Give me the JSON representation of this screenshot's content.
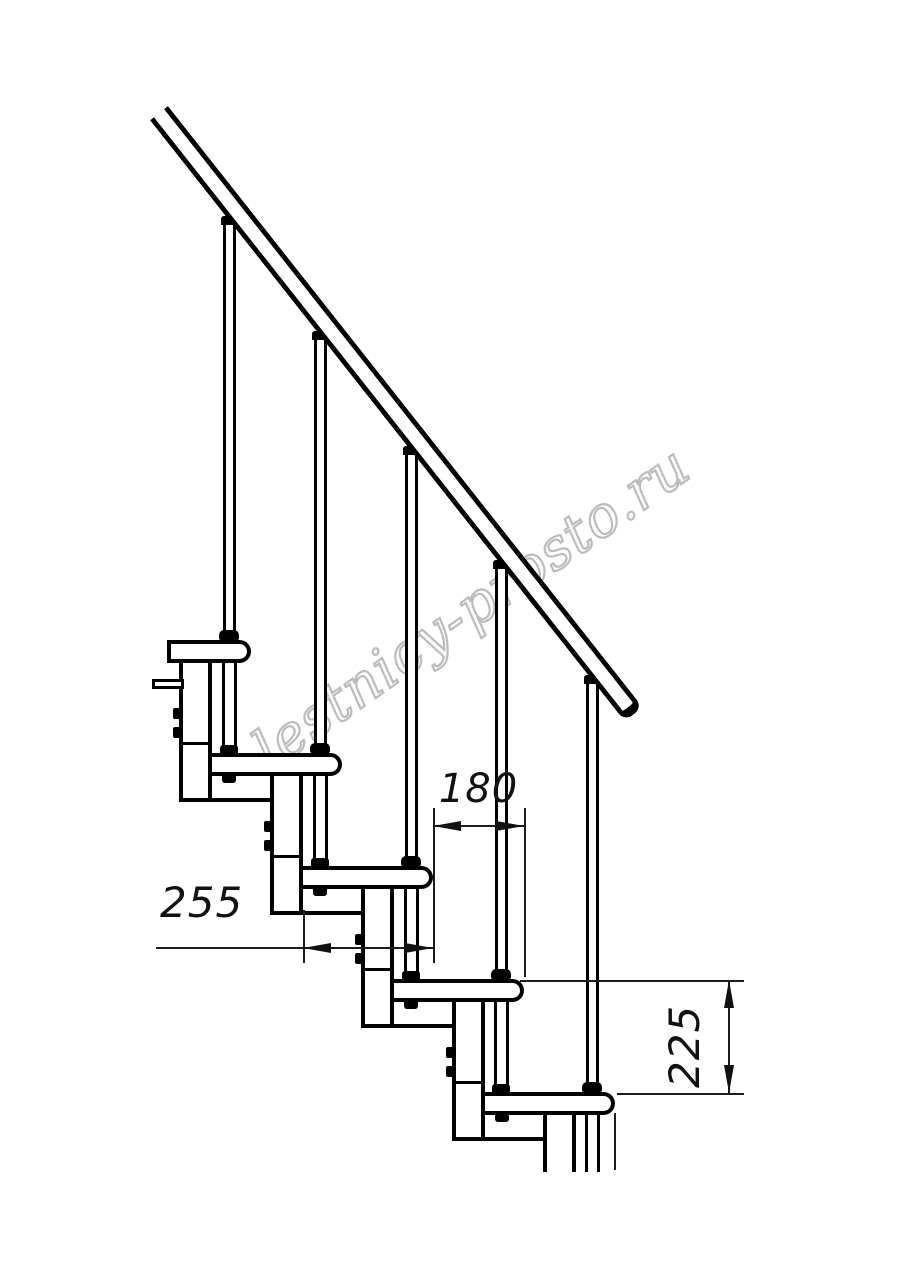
{
  "watermark": {
    "text": "lestnicy-prosto.ru",
    "color": "#bcbcbc"
  },
  "drawing": {
    "type": "modular-staircase-side-elevation",
    "steps_visible": 5,
    "balusters_visible": 5
  },
  "dimensions": {
    "step_run": {
      "label": "180"
    },
    "tread_depth": {
      "label": "255"
    },
    "step_rise": {
      "label": "225"
    }
  },
  "colors": {
    "line": "#000000",
    "dimension_line": "#1c1c1c",
    "watermark": "#bcbcbc",
    "background": "#ffffff"
  }
}
